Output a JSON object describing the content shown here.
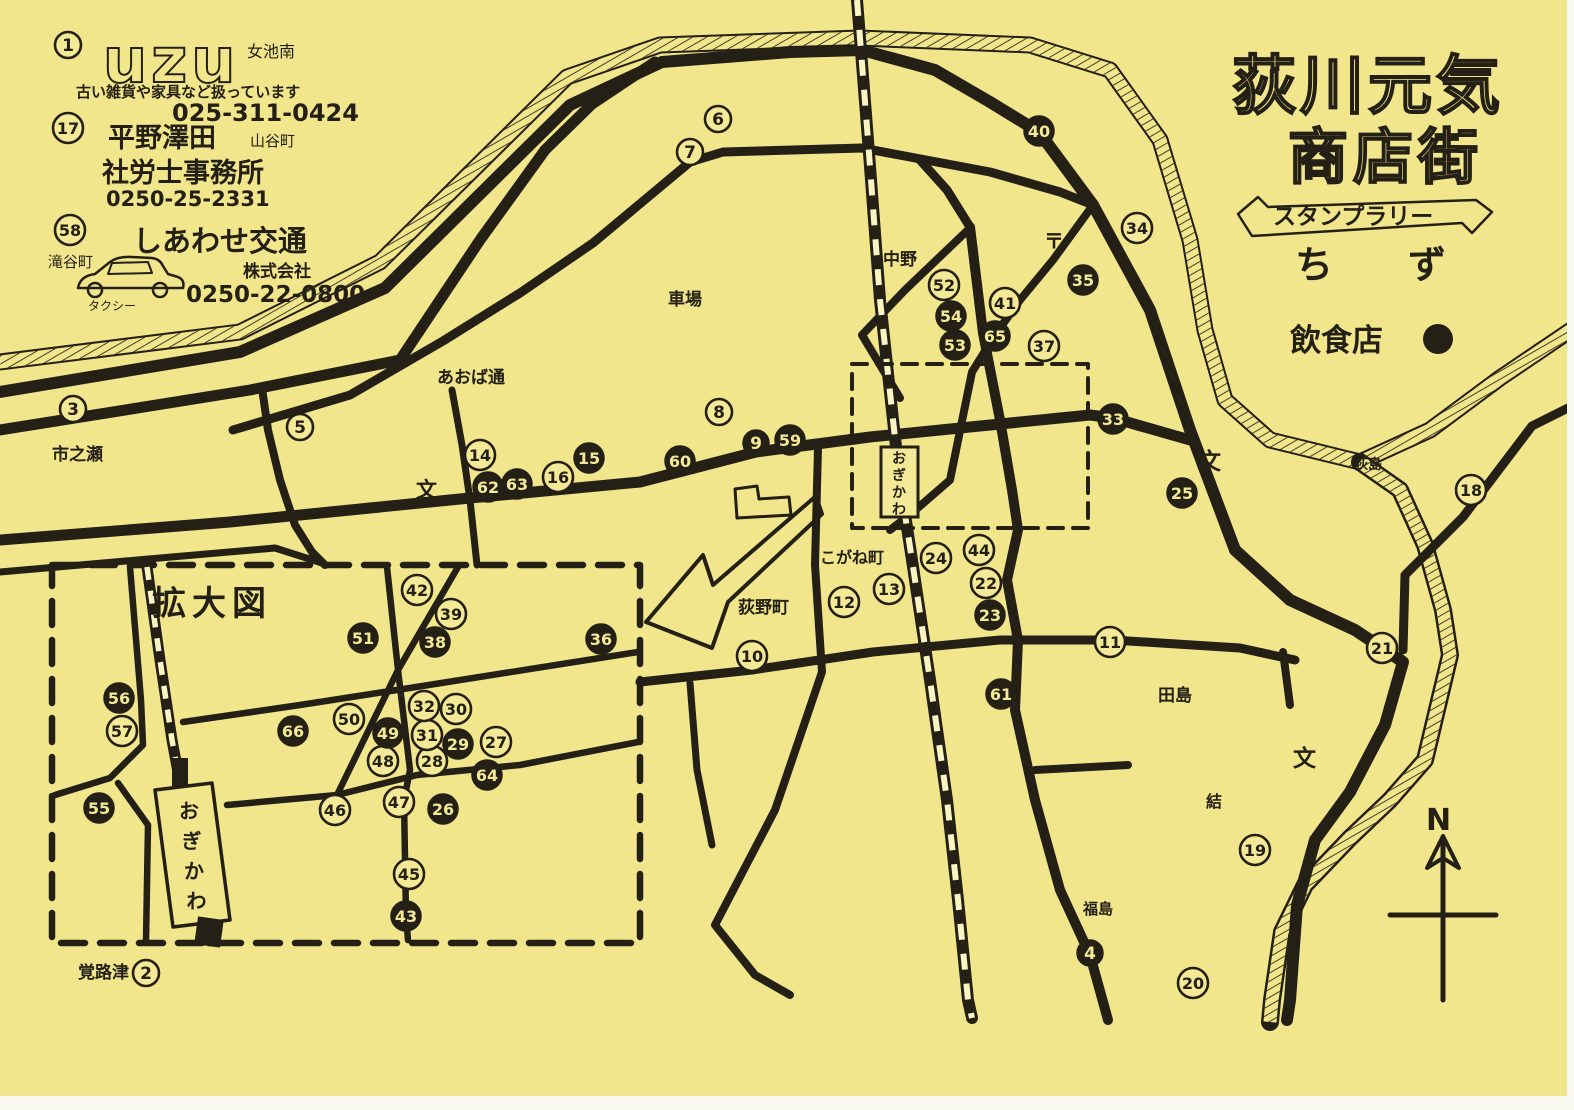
{
  "title": {
    "line1": "荻川元気",
    "line2": "商店街",
    "banner": "スタンプラリー",
    "word1": "ち",
    "word2": "ず"
  },
  "legend": {
    "restaurant_label": "飲食店"
  },
  "compass": {
    "label": "N"
  },
  "inset": {
    "label": "拡大図"
  },
  "ads": [
    {
      "number": "1",
      "logo": "uzu",
      "area": "女池南",
      "desc": "古い雑貨や家具など扱っています",
      "phone": "025-311-0424"
    },
    {
      "number": "17",
      "name1": "平野澤田",
      "area": "山谷町",
      "name2": "社労士事務所",
      "phone": "0250-25-2331"
    },
    {
      "number": "58",
      "name": "しあわせ交通",
      "sub": "株式会社",
      "area": "滝谷町",
      "vehicle": "タクシー",
      "phone": "0250-22-0800"
    }
  ],
  "stations": [
    {
      "name": "おぎかわ",
      "kind": "main-map"
    },
    {
      "name": "おぎかわ",
      "kind": "inset"
    }
  ],
  "places": [
    {
      "id": "ichinose",
      "t": "市之瀬",
      "x": 52,
      "y": 460,
      "s": 17,
      "b": 1
    },
    {
      "id": "aoba-dori",
      "t": "あおば通",
      "x": 437,
      "y": 383,
      "s": 17,
      "b": 1
    },
    {
      "id": "kurumaba",
      "t": "車場",
      "x": 668,
      "y": 305,
      "s": 17,
      "b": 1
    },
    {
      "id": "nakano",
      "t": "中野",
      "x": 883,
      "y": 265,
      "s": 17,
      "b": 1
    },
    {
      "id": "post-mark",
      "t": "〒",
      "x": 1044,
      "y": 248,
      "s": 20,
      "b": 1
    },
    {
      "id": "ogishima",
      "t": "荻島",
      "x": 1354,
      "y": 469,
      "s": 14,
      "b": 1
    },
    {
      "id": "tajima",
      "t": "田島",
      "x": 1158,
      "y": 701,
      "s": 17,
      "b": 1
    },
    {
      "id": "musubi",
      "t": "結",
      "x": 1206,
      "y": 807,
      "s": 16,
      "b": 1
    },
    {
      "id": "fukushima",
      "t": "福島",
      "x": 1083,
      "y": 914,
      "s": 15,
      "b": 1
    },
    {
      "id": "oginomachi",
      "t": "荻野町",
      "x": 738,
      "y": 613,
      "s": 17,
      "b": 1
    },
    {
      "id": "kogane-cho",
      "t": "こがね町",
      "x": 820,
      "y": 563,
      "s": 16,
      "b": 1
    },
    {
      "id": "kakurozu",
      "t": "覚路津",
      "x": 78,
      "y": 978,
      "s": 17,
      "b": 1
    },
    {
      "id": "school-1",
      "t": "文",
      "x": 416,
      "y": 497,
      "s": 21,
      "b": 1
    },
    {
      "id": "school-2",
      "t": "文",
      "x": 1198,
      "y": 469,
      "s": 23,
      "b": 1
    },
    {
      "id": "school-3",
      "t": "文",
      "x": 1293,
      "y": 766,
      "s": 23,
      "b": 1
    }
  ],
  "markers": [
    {
      "n": "1",
      "x": 68,
      "y": 45,
      "f": 0
    },
    {
      "n": "17",
      "x": 68,
      "y": 128,
      "f": 0
    },
    {
      "n": "58",
      "x": 70,
      "y": 230,
      "f": 0
    },
    {
      "n": "2",
      "x": 146,
      "y": 973,
      "f": 0
    },
    {
      "n": "3",
      "x": 73,
      "y": 409,
      "f": 0
    },
    {
      "n": "4",
      "x": 1090,
      "y": 953,
      "f": 1
    },
    {
      "n": "5",
      "x": 300,
      "y": 427,
      "f": 0
    },
    {
      "n": "6",
      "x": 718,
      "y": 119,
      "f": 0
    },
    {
      "n": "7",
      "x": 690,
      "y": 152,
      "f": 0
    },
    {
      "n": "8",
      "x": 719,
      "y": 412,
      "f": 0
    },
    {
      "n": "9",
      "x": 756,
      "y": 443,
      "f": 1
    },
    {
      "n": "10",
      "x": 752,
      "y": 656,
      "f": 0
    },
    {
      "n": "11",
      "x": 1110,
      "y": 642,
      "f": 0
    },
    {
      "n": "12",
      "x": 844,
      "y": 602,
      "f": 0
    },
    {
      "n": "13",
      "x": 889,
      "y": 589,
      "f": 0
    },
    {
      "n": "14",
      "x": 480,
      "y": 455,
      "f": 0
    },
    {
      "n": "15",
      "x": 589,
      "y": 458,
      "f": 1
    },
    {
      "n": "16",
      "x": 558,
      "y": 477,
      "f": 0
    },
    {
      "n": "18",
      "x": 1471,
      "y": 490,
      "f": 0
    },
    {
      "n": "19",
      "x": 1255,
      "y": 850,
      "f": 0
    },
    {
      "n": "20",
      "x": 1193,
      "y": 983,
      "f": 0
    },
    {
      "n": "21",
      "x": 1382,
      "y": 648,
      "f": 0
    },
    {
      "n": "22",
      "x": 986,
      "y": 583,
      "f": 0
    },
    {
      "n": "23",
      "x": 990,
      "y": 615,
      "f": 1
    },
    {
      "n": "24",
      "x": 936,
      "y": 558,
      "f": 0
    },
    {
      "n": "25",
      "x": 1182,
      "y": 493,
      "f": 1
    },
    {
      "n": "33",
      "x": 1113,
      "y": 419,
      "f": 1
    },
    {
      "n": "34",
      "x": 1137,
      "y": 228,
      "f": 0
    },
    {
      "n": "35",
      "x": 1083,
      "y": 280,
      "f": 1
    },
    {
      "n": "37",
      "x": 1044,
      "y": 346,
      "f": 0
    },
    {
      "n": "40",
      "x": 1039,
      "y": 131,
      "f": 1
    },
    {
      "n": "41",
      "x": 1005,
      "y": 303,
      "f": 0
    },
    {
      "n": "44",
      "x": 979,
      "y": 550,
      "f": 0
    },
    {
      "n": "52",
      "x": 944,
      "y": 285,
      "f": 0
    },
    {
      "n": "53",
      "x": 955,
      "y": 345,
      "f": 1
    },
    {
      "n": "54",
      "x": 951,
      "y": 316,
      "f": 1
    },
    {
      "n": "59",
      "x": 790,
      "y": 440,
      "f": 1
    },
    {
      "n": "60",
      "x": 680,
      "y": 461,
      "f": 1
    },
    {
      "n": "61",
      "x": 1001,
      "y": 694,
      "f": 1
    },
    {
      "n": "62",
      "x": 488,
      "y": 487,
      "f": 1
    },
    {
      "n": "63",
      "x": 517,
      "y": 484,
      "f": 1
    },
    {
      "n": "65",
      "x": 995,
      "y": 336,
      "f": 1
    },
    {
      "n": "26",
      "x": 443,
      "y": 809,
      "f": 1
    },
    {
      "n": "27",
      "x": 496,
      "y": 742,
      "f": 0
    },
    {
      "n": "28",
      "x": 432,
      "y": 761,
      "f": 0
    },
    {
      "n": "29",
      "x": 458,
      "y": 744,
      "f": 1
    },
    {
      "n": "30",
      "x": 456,
      "y": 709,
      "f": 0
    },
    {
      "n": "31",
      "x": 427,
      "y": 735,
      "f": 0
    },
    {
      "n": "32",
      "x": 424,
      "y": 706,
      "f": 0
    },
    {
      "n": "36",
      "x": 601,
      "y": 639,
      "f": 1
    },
    {
      "n": "38",
      "x": 435,
      "y": 642,
      "f": 1
    },
    {
      "n": "39",
      "x": 451,
      "y": 614,
      "f": 0
    },
    {
      "n": "42",
      "x": 417,
      "y": 590,
      "f": 0
    },
    {
      "n": "43",
      "x": 406,
      "y": 916,
      "f": 1
    },
    {
      "n": "45",
      "x": 409,
      "y": 874,
      "f": 0
    },
    {
      "n": "46",
      "x": 335,
      "y": 810,
      "f": 0
    },
    {
      "n": "47",
      "x": 399,
      "y": 802,
      "f": 0
    },
    {
      "n": "48",
      "x": 383,
      "y": 761,
      "f": 0
    },
    {
      "n": "49",
      "x": 388,
      "y": 733,
      "f": 1
    },
    {
      "n": "50",
      "x": 349,
      "y": 719,
      "f": 0
    },
    {
      "n": "51",
      "x": 363,
      "y": 638,
      "f": 1
    },
    {
      "n": "55",
      "x": 99,
      "y": 808,
      "f": 1
    },
    {
      "n": "56",
      "x": 119,
      "y": 698,
      "f": 1
    },
    {
      "n": "57",
      "x": 122,
      "y": 731,
      "f": 0
    },
    {
      "n": "64",
      "x": 487,
      "y": 775,
      "f": 1
    },
    {
      "n": "66",
      "x": 293,
      "y": 731,
      "f": 1
    }
  ]
}
